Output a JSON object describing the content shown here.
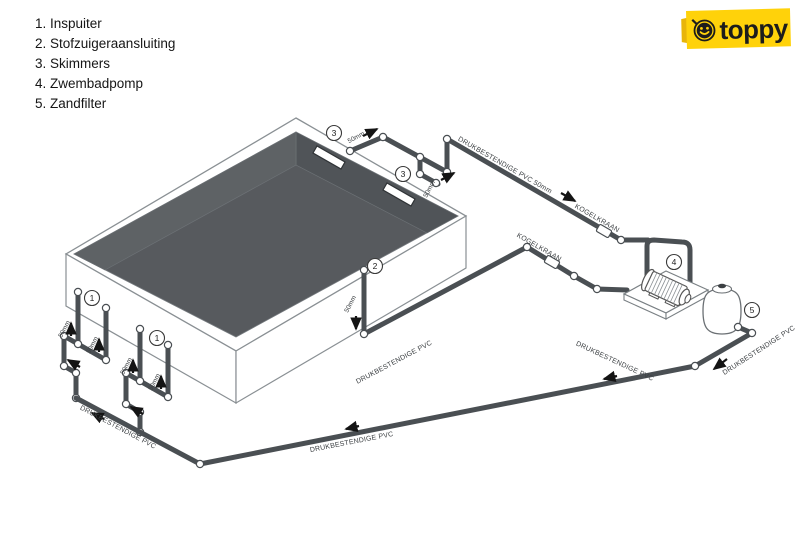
{
  "legend": {
    "items": [
      "1. Inspuiter",
      "2. Stofzuigeraansluiting",
      "3. Skimmers",
      "4. Zwembadpomp",
      "5. Zandfilter"
    ]
  },
  "logo": {
    "text": "toppy"
  },
  "callouts": {
    "n1": "1",
    "n2": "2",
    "n3": "3",
    "n4": "4",
    "n5": "5"
  },
  "pipe_labels": {
    "size": "50mm",
    "pressure_pvc": "DRUKBESTENDIGE PVC",
    "pressure_pvc_50": "DRUKBESTENDIGE PVC  50mm",
    "ball_valve": "KOGELKRAAN"
  },
  "colors": {
    "pipe": "#4a4f53",
    "pool_floor": "#575a5e",
    "logo_yellow": "#ffd20a",
    "ink": "#1c1c1c"
  }
}
